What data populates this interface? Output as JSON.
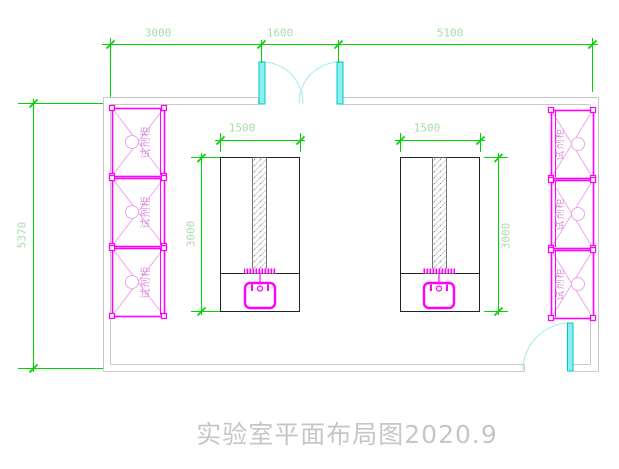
{
  "drawing": {
    "title": "实验室平面布局图2020.9"
  },
  "dimensions": {
    "top_segments": [
      {
        "label": "3000"
      },
      {
        "label": "1600"
      },
      {
        "label": "5100"
      }
    ],
    "left_wall_height": "5370",
    "bench_left": {
      "width": "1500",
      "depth": "3000"
    },
    "bench_right": {
      "width": "1500",
      "depth": "3000"
    }
  },
  "cabinets": {
    "label": "试剂柜",
    "count_left": 3,
    "count_right": 3
  },
  "doors": {
    "top": "double-swing-door",
    "bottom_right": "single-swing-door"
  },
  "colors": {
    "dimension_green": "#00d500",
    "dimension_text": "#a9dba9",
    "cabinet_magenta": "#ff00ff",
    "cabinet_light": "#eda6ed",
    "door_cyan": "#00c8c8",
    "door_fill": "#8cf0f0",
    "wall_gray": "#c8c8c8",
    "bench_black": "#222222",
    "title_gray": "#c6c6c6"
  }
}
